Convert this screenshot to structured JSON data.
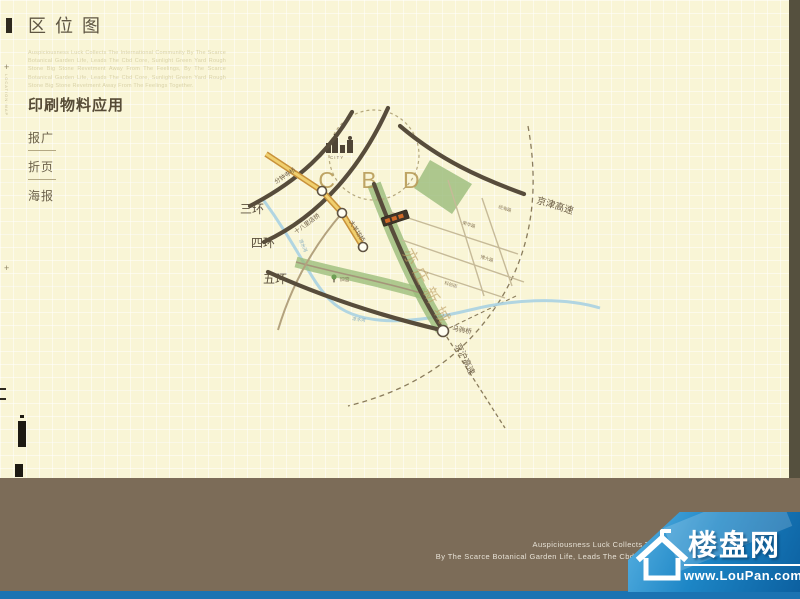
{
  "header": {
    "title": "区位图",
    "intro": "Auspiciousness Luck Collects The International Community By The Scarce Botanical Garden Life, Leads The Cbd Core, Sunlight Green Yard Rough Stone Big Stone Revetment Away From The Feelings, By The Scarce Botanical Garden Life, Leads The Cbd Core, Sunlight Green Yard Rough Stone Big Stone Revetment Away From The Feelings Together."
  },
  "sidebar": {
    "heading": "印刷物料应用",
    "items": [
      "报广",
      "折页",
      "海报"
    ],
    "plus_mark": "+",
    "side_note": "LOCATION·MAP"
  },
  "map": {
    "cbd": "C B D",
    "city_tag": "CITY",
    "rings": [
      "三环",
      "四环",
      "五环"
    ],
    "bridges": [
      "分钟寺桥",
      "十八里店桥",
      "大羊坊桥",
      "马驹桥"
    ],
    "highways": [
      "京津高速",
      "京沪高速"
    ],
    "district": "亦庄新城",
    "river": "凉水河",
    "streets": [
      "荣华路",
      "博大路",
      "经海路",
      "科创街"
    ],
    "poi": "旧宫"
  },
  "footer": {
    "lines": [
      "Auspiciousness Luck Collects The International Community",
      "By The Scarce Botanical Garden Life, Leads The Cbd Core, Sunlight Green Yard Rou",
      "Away From The Feelings"
    ]
  },
  "watermark": {
    "brand": "楼盘网",
    "url": "www.LouPan.com"
  },
  "colors": {
    "page_bg": "#f9f5d6",
    "footer_bg": "#7c6c58",
    "edge_strip": "#55503e",
    "blue": "#1b73b2",
    "road_dark": "#574c3b",
    "highway_fill": "#f0cf6e",
    "highway_casing": "#c8923a",
    "green": "#9abc7a",
    "river": "#a9d2e2",
    "cbd": "#b89c58"
  }
}
